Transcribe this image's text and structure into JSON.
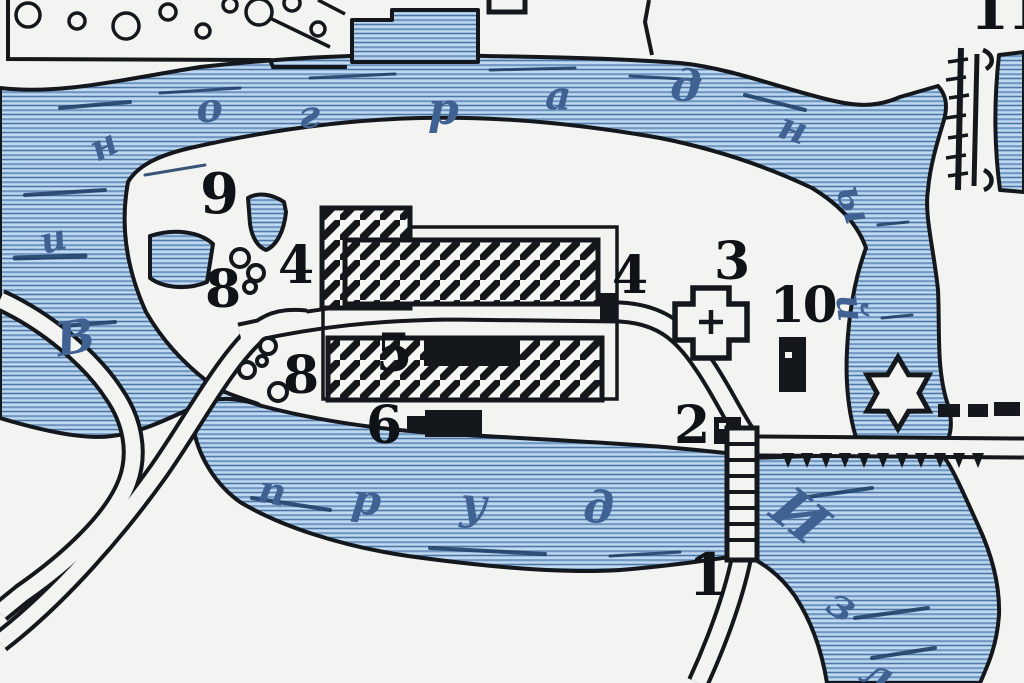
{
  "map": {
    "type": "historical-estate-plan",
    "colors": {
      "paper": "#f3f4f1",
      "water_base": "#bed9f0",
      "water_stripe_light": "#7298c4",
      "water_stripe_dark": "#4c76a6",
      "water_streak": "#1a3a62",
      "ink": "#14181c",
      "letter_blue": "#3f6293"
    },
    "reading": {
      "pond_name_around_island": "Виноградный",
      "pond_word_south": "пруд",
      "river_partial": "Изл"
    },
    "letters": [
      {
        "ch": "В",
        "x": 52,
        "y": 318,
        "s": 46,
        "r": -10
      },
      {
        "ch": "и",
        "x": 36,
        "y": 225,
        "s": 36,
        "r": -14
      },
      {
        "ch": "н",
        "x": 84,
        "y": 135,
        "s": 36,
        "r": -26
      },
      {
        "ch": "о",
        "x": 194,
        "y": 90,
        "s": 40,
        "r": -6
      },
      {
        "ch": "г",
        "x": 298,
        "y": 96,
        "s": 38,
        "r": -2
      },
      {
        "ch": "р",
        "x": 428,
        "y": 88,
        "s": 44,
        "r": 0
      },
      {
        "ch": "а",
        "x": 546,
        "y": 76,
        "s": 40,
        "r": 2
      },
      {
        "ch": "д",
        "x": 672,
        "y": 64,
        "s": 44,
        "r": 4
      },
      {
        "ch": "н",
        "x": 786,
        "y": 106,
        "s": 38,
        "r": 18
      },
      {
        "ch": "ы",
        "x": 866,
        "y": 180,
        "s": 38,
        "r": 72
      },
      {
        "ch": "й",
        "x": 868,
        "y": 292,
        "s": 38,
        "r": 84
      },
      {
        "ch": "п",
        "x": 262,
        "y": 470,
        "s": 38,
        "r": 10
      },
      {
        "ch": "р",
        "x": 354,
        "y": 478,
        "s": 42,
        "r": 6
      },
      {
        "ch": "у",
        "x": 462,
        "y": 482,
        "s": 44,
        "r": 4
      },
      {
        "ch": "д",
        "x": 584,
        "y": 486,
        "s": 44,
        "r": 2
      },
      {
        "ch": "И",
        "x": 796,
        "y": 478,
        "s": 56,
        "r": 38
      },
      {
        "ch": "з",
        "x": 842,
        "y": 580,
        "s": 42,
        "r": 32
      },
      {
        "ch": "л",
        "x": 874,
        "y": 648,
        "s": 42,
        "r": 28
      }
    ],
    "numbers": [
      {
        "n": "9",
        "x": 200,
        "y": 166,
        "s": 56
      },
      {
        "n": "8",
        "x": 205,
        "y": 264,
        "s": 52
      },
      {
        "n": "4",
        "x": 278,
        "y": 240,
        "s": 52
      },
      {
        "n": "4",
        "x": 612,
        "y": 250,
        "s": 52
      },
      {
        "n": "3",
        "x": 714,
        "y": 236,
        "s": 52
      },
      {
        "n": "10",
        "x": 770,
        "y": 280,
        "s": 50
      },
      {
        "n": "5",
        "x": 376,
        "y": 328,
        "s": 52
      },
      {
        "n": "6",
        "x": 366,
        "y": 400,
        "s": 52
      },
      {
        "n": "8",
        "x": 283,
        "y": 350,
        "s": 52
      },
      {
        "n": "2",
        "x": 674,
        "y": 400,
        "s": 52
      },
      {
        "n": "1",
        "x": 688,
        "y": 546,
        "s": 58
      },
      {
        "n": "11",
        "x": 970,
        "y": -18,
        "s": 56
      }
    ]
  }
}
